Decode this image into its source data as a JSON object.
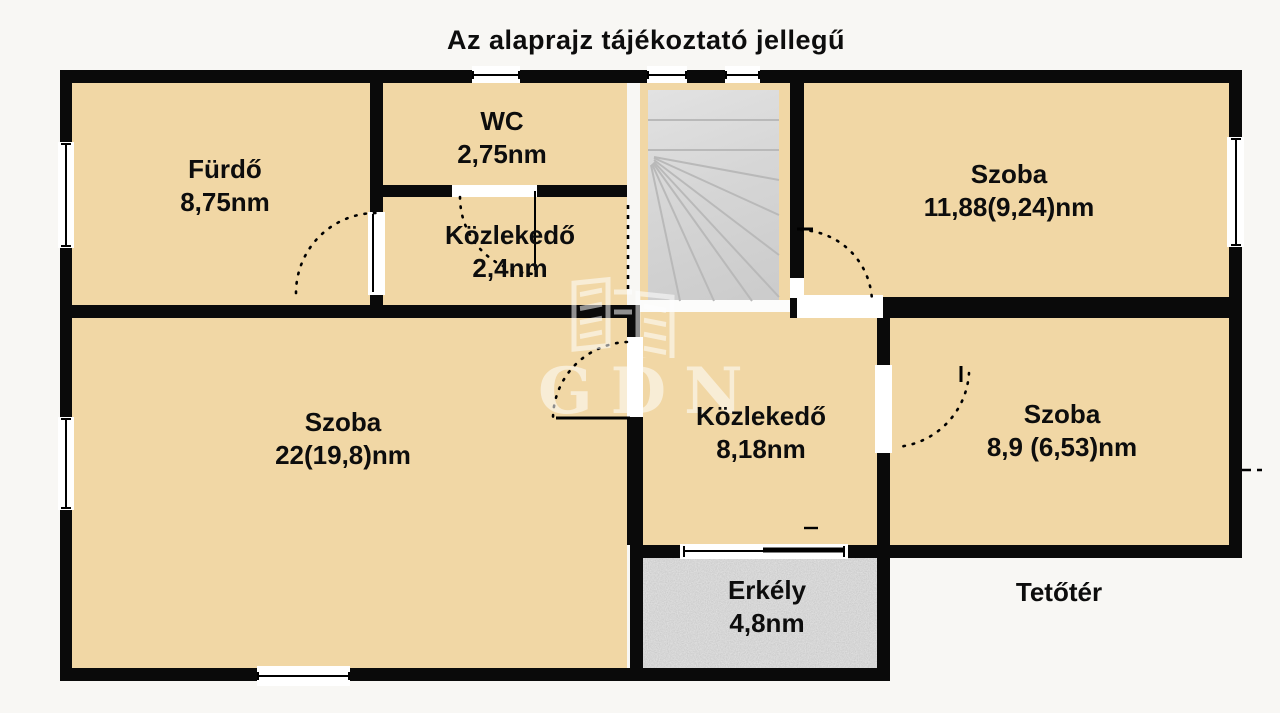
{
  "title": "Az alaprajz tájékoztató jellegű",
  "watermark_text": "GDN",
  "outside_label": "Tetőtér",
  "rooms": [
    {
      "name": "Fürdő",
      "area": "8,75nm"
    },
    {
      "name": "WC",
      "area": "2,75nm"
    },
    {
      "name": "Közlekedő",
      "area": "2,4nm"
    },
    {
      "name": "Szoba",
      "area": "11,88(9,24)nm"
    },
    {
      "name": "Szoba",
      "area": "22(19,8)nm"
    },
    {
      "name": "Közlekedő",
      "area": "8,18nm"
    },
    {
      "name": "Szoba",
      "area": "8,9 (6,53)nm"
    },
    {
      "name": "Erkély",
      "area": "4,8nm"
    }
  ],
  "colors": {
    "floor": "#f1d7a5",
    "wall": "#0a0a0a",
    "background": "#f8f7f4",
    "stairs": "#d6d6d6",
    "balcony": "#c9c9c9"
  }
}
